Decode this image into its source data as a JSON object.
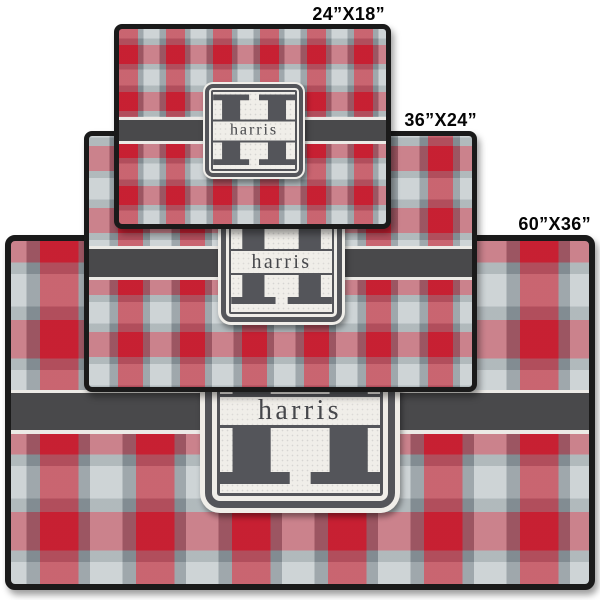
{
  "page": {
    "background": "#ffffff",
    "description": "Red plaid personalized rug shown in three stacked size previews"
  },
  "product": {
    "pattern": "red-gray-plaid",
    "monogram_initial": "H",
    "monogram_name": "harris"
  },
  "sizes": [
    {
      "id": "24x18",
      "label": "24”X18”"
    },
    {
      "id": "36x24",
      "label": "36”X24”"
    },
    {
      "id": "60x36",
      "label": "60”X36”"
    }
  ],
  "colors": {
    "page_bg": "#ffffff",
    "plaid_red": "#c72033",
    "plaid_light": "#ced4d6",
    "plaid_gray": "#8f989d",
    "stripe_dark": "#49494b",
    "pinstripe": "#eceae6",
    "rug_border": "#1a1a1a",
    "plaque_bg": "#f0eee9",
    "plaque_border": "#54555a",
    "h_color": "#54555a",
    "text_dark": "#46474b",
    "size_label_color": "#050505"
  }
}
